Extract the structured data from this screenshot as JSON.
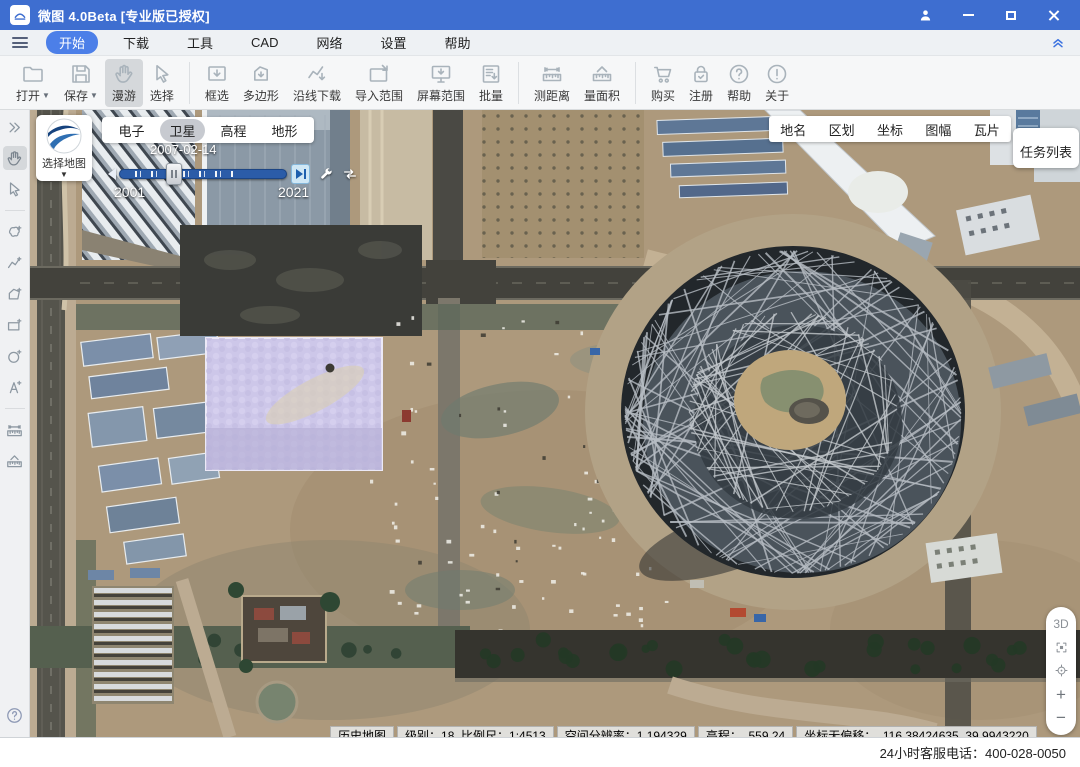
{
  "window": {
    "title": "微图 4.0Beta [专业版已授权]"
  },
  "menu": {
    "items": [
      "开始",
      "下载",
      "工具",
      "CAD",
      "网络",
      "设置",
      "帮助"
    ],
    "active_index": 0
  },
  "toolbar": {
    "groups": [
      {
        "items": [
          {
            "name": "open-button",
            "label": "打开",
            "icon": "folder-icon",
            "dropdown": true
          },
          {
            "name": "save-button",
            "label": "保存",
            "icon": "save-icon",
            "dropdown": true
          },
          {
            "name": "pan-button",
            "label": "漫游",
            "icon": "hand-icon",
            "active": true
          },
          {
            "name": "select-button",
            "label": "选择",
            "icon": "cursor-icon"
          }
        ]
      },
      {
        "items": [
          {
            "name": "box-select-button",
            "label": "框选",
            "icon": "box-download-icon"
          },
          {
            "name": "polygon-button",
            "label": "多边形",
            "icon": "polygon-download-icon"
          },
          {
            "name": "along-line-download-button",
            "label": "沿线下载",
            "icon": "polyline-download-icon"
          },
          {
            "name": "import-extent-button",
            "label": "导入范围",
            "icon": "import-extent-icon"
          },
          {
            "name": "screen-extent-button",
            "label": "屏幕范围",
            "icon": "screen-extent-icon"
          },
          {
            "name": "batch-button",
            "label": "批量",
            "icon": "batch-icon"
          }
        ]
      },
      {
        "items": [
          {
            "name": "measure-distance-button",
            "label": "测距离",
            "icon": "ruler-icon"
          },
          {
            "name": "measure-area-button",
            "label": "量面积",
            "icon": "area-ruler-icon"
          }
        ]
      },
      {
        "items": [
          {
            "name": "buy-button",
            "label": "购买",
            "icon": "cart-icon"
          },
          {
            "name": "register-button",
            "label": "注册",
            "icon": "register-icon"
          },
          {
            "name": "help-button",
            "label": "帮助",
            "icon": "help-circle-icon"
          },
          {
            "name": "about-button",
            "label": "关于",
            "icon": "about-circle-icon"
          }
        ]
      }
    ]
  },
  "side_toolbar": {
    "items": [
      {
        "name": "collapse-panel",
        "icon": "double-chevron-right-icon"
      },
      {
        "name": "pan-tool",
        "icon": "hand-icon",
        "active": true
      },
      {
        "name": "select-tool",
        "icon": "cursor-icon"
      },
      {
        "divider": true
      },
      {
        "name": "draw-freeform",
        "icon": "freeform-plus-icon"
      },
      {
        "name": "draw-polyline",
        "icon": "polyline-plus-icon"
      },
      {
        "name": "draw-polygon",
        "icon": "polygon-plus-icon"
      },
      {
        "name": "draw-rectangle",
        "icon": "rectangle-plus-icon"
      },
      {
        "name": "draw-circle",
        "icon": "circle-plus-icon"
      },
      {
        "name": "draw-text",
        "icon": "text-plus-icon"
      },
      {
        "divider": true
      },
      {
        "name": "measure-distance-tool",
        "icon": "ruler-icon"
      },
      {
        "name": "measure-area-tool",
        "icon": "area-ruler-icon"
      }
    ]
  },
  "map_overlay": {
    "source_button": {
      "label": "选择地图"
    },
    "layer_tabs": {
      "items": [
        "电子",
        "卫星",
        "高程",
        "地形"
      ],
      "active_index": 1
    },
    "timeline": {
      "current_date": "2007-02-14",
      "range_start": "2001",
      "range_end": "2021"
    },
    "info_tabs": {
      "items": [
        "地名",
        "区划",
        "坐标",
        "图幅",
        "瓦片"
      ]
    },
    "task_list_button": "任务列表",
    "view_controls": [
      {
        "name": "view-3d-button",
        "label": "3D"
      },
      {
        "name": "fullscreen-button",
        "icon": "fullscreen-icon"
      },
      {
        "name": "locate-button",
        "icon": "locate-icon"
      },
      {
        "name": "zoom-in-button",
        "label": "+"
      },
      {
        "name": "zoom-out-button",
        "label": "−"
      }
    ],
    "status_bar": {
      "segments": [
        "历史地图",
        "级别：18  比例尺：1:4513",
        "空间分辨率：1.194329",
        "高程：  559.24",
        "坐标无偏移：  116.38424635  39.9943220"
      ]
    }
  },
  "footer": {
    "service_hotline": "24小时客服电话：400-028-0050"
  },
  "colors": {
    "titlebar": "#3e6ed0",
    "accent_blue": "#4c7fe8",
    "active_tool_bg": "#d5d8db",
    "timeline_track": "#2b5ca8",
    "next_button_bg": "#cfe7f5"
  }
}
